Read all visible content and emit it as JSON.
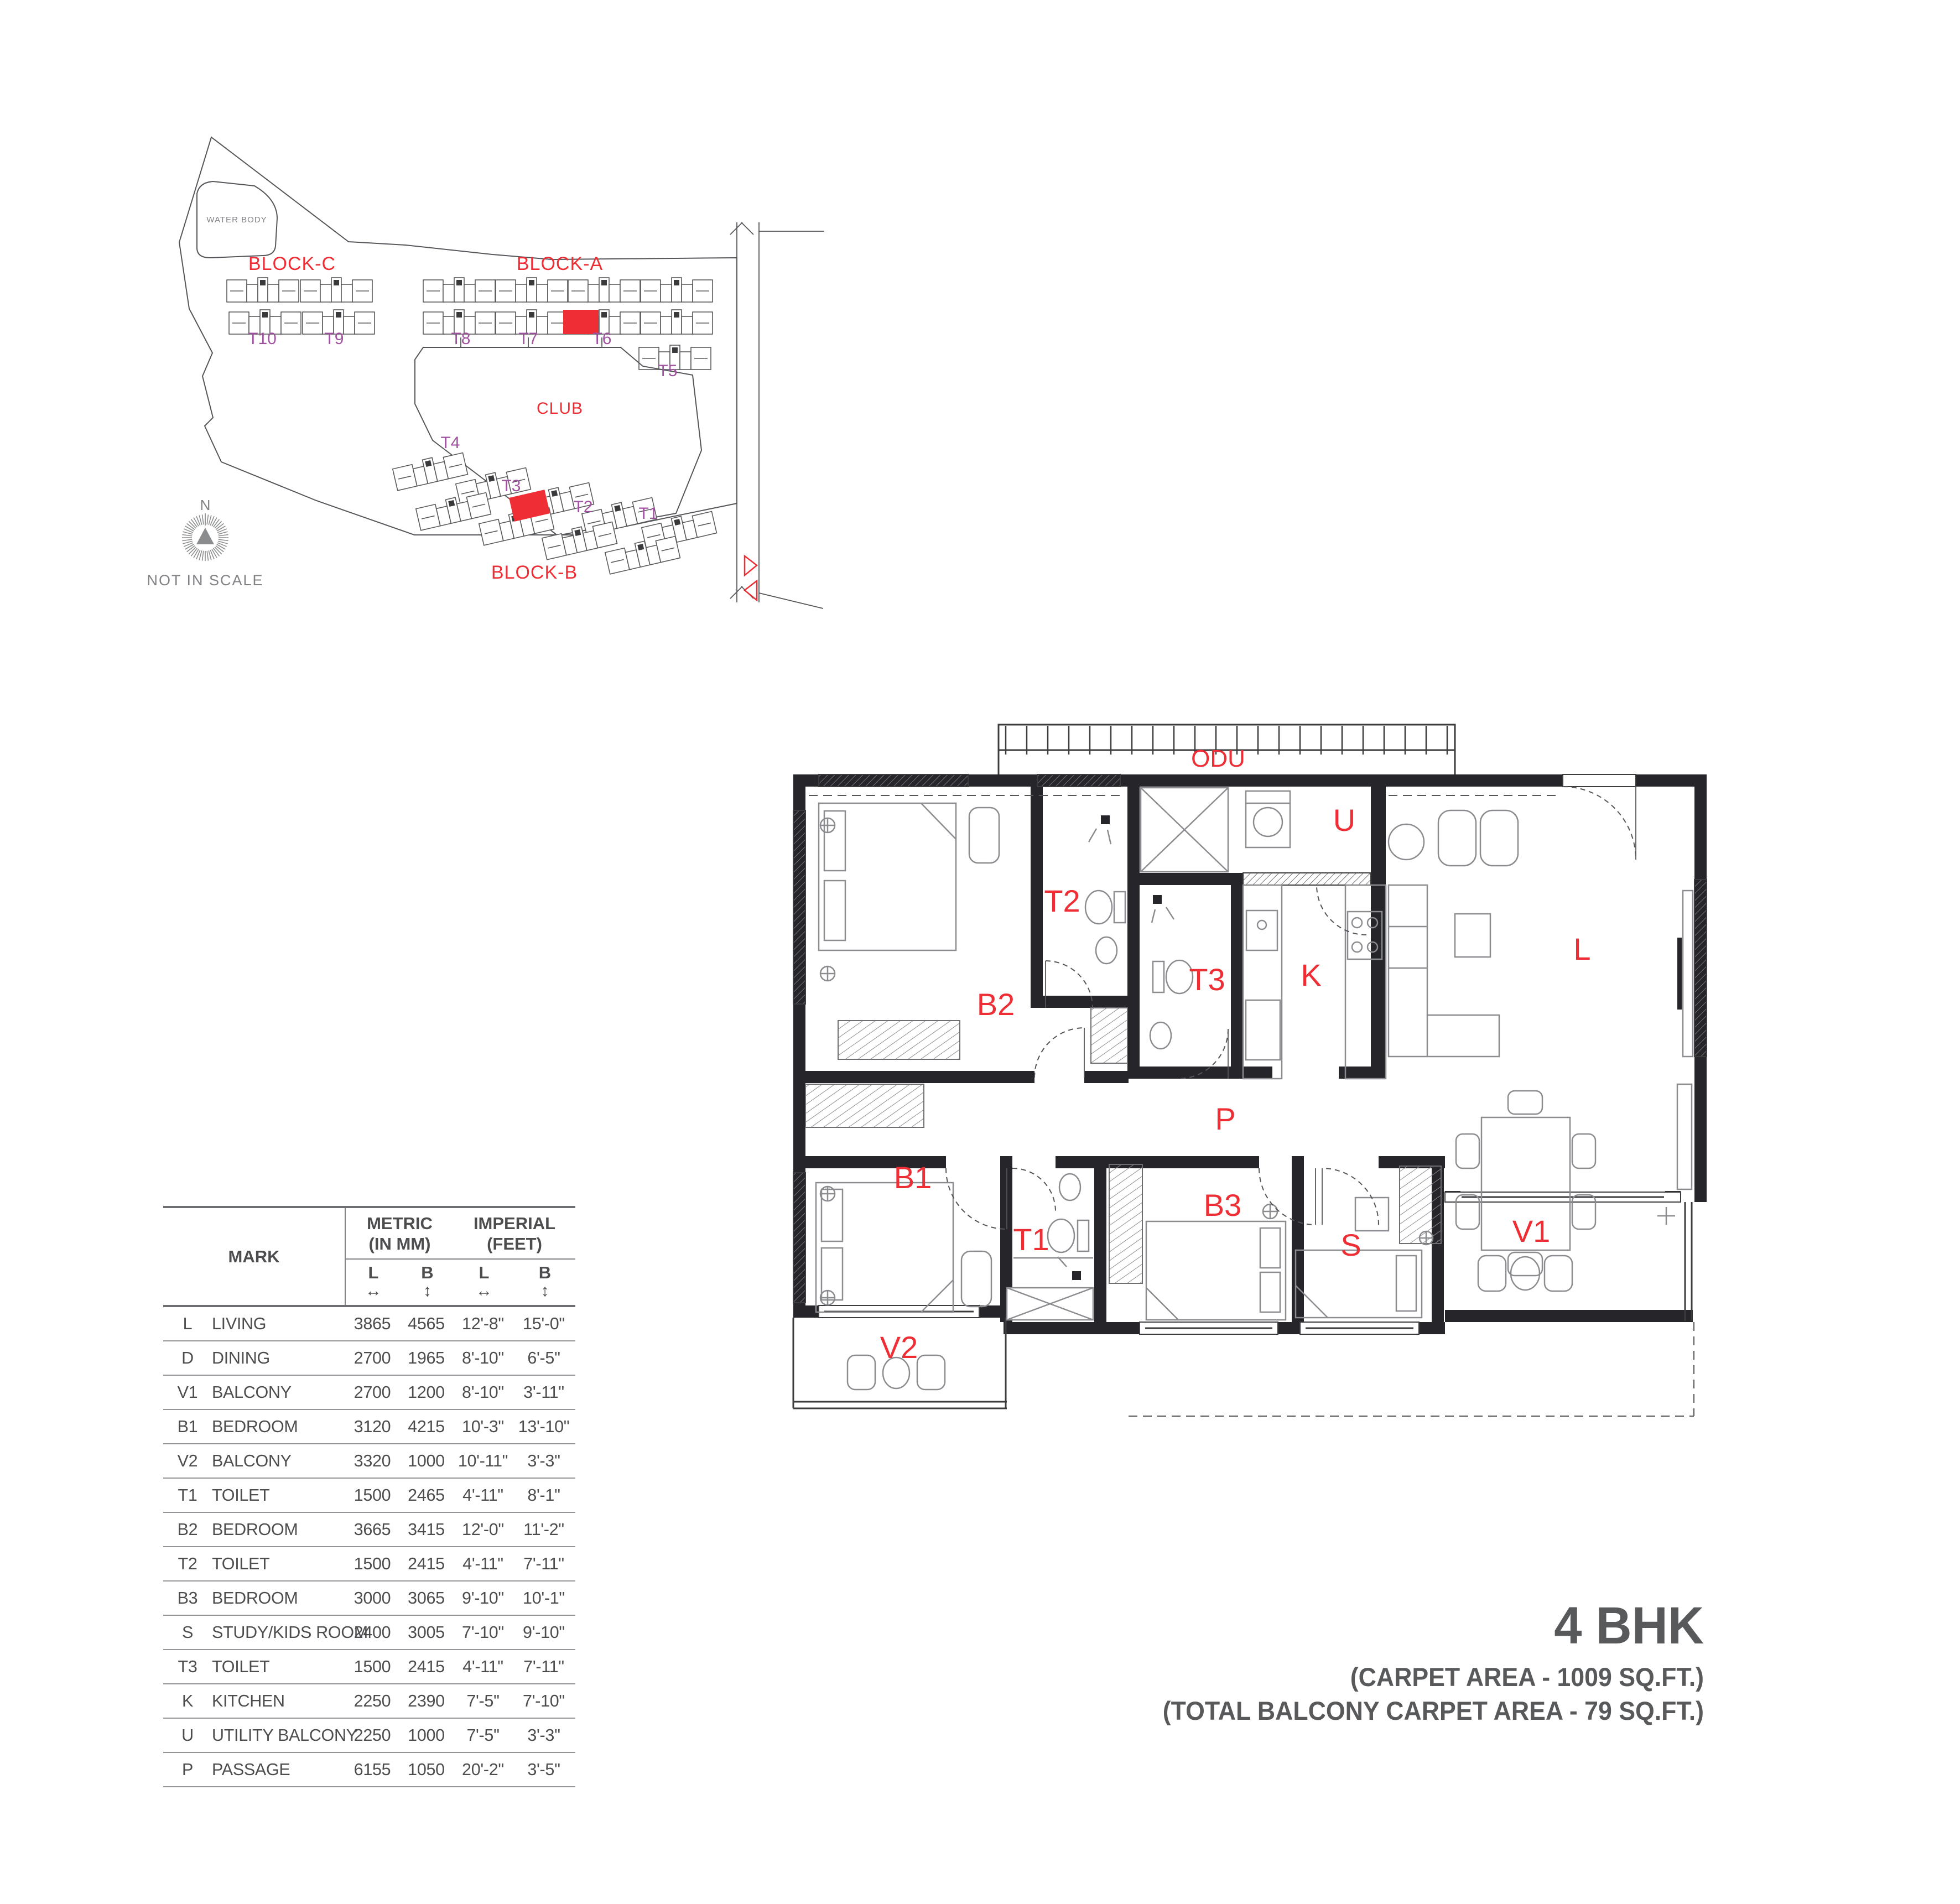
{
  "colors": {
    "accent_red": "#ee2e34",
    "tower_purple": "#a0519f",
    "title_gray": "#58595b",
    "wall_black": "#26262a"
  },
  "site_plan": {
    "water_body_label": "WATER BODY",
    "block_c": "BLOCK-C",
    "block_a": "BLOCK-A",
    "block_b": "BLOCK-B",
    "club_label": "CLUB",
    "towers": {
      "t1": "T1",
      "t2": "T2",
      "t3": "T3",
      "t4": "T4",
      "t5": "T5",
      "t6": "T6",
      "t7": "T7",
      "t8": "T8",
      "t9": "T9",
      "t10": "T10"
    },
    "north_label": "N",
    "scale_note": "NOT IN SCALE"
  },
  "floor_plan": {
    "labels": {
      "odu": "ODU",
      "u": "U",
      "t2": "T2",
      "t3": "T3",
      "k": "K",
      "l": "L",
      "b2": "B2",
      "p": "P",
      "b1": "B1",
      "t1": "T1",
      "b3": "B3",
      "s": "S",
      "v1": "V1",
      "v2": "V2"
    }
  },
  "dimension_table": {
    "header": {
      "mark": "MARK",
      "metric_line1": "METRIC",
      "metric_line2": "(IN MM)",
      "imperial_line1": "IMPERIAL",
      "imperial_line2": "(FEET)",
      "col_l": "L",
      "col_b": "B",
      "arrow_h": "↔",
      "arrow_v": "↕"
    },
    "rows": [
      {
        "mark": "L",
        "name": "LIVING",
        "ml": "3865",
        "mb": "4565",
        "il": "12'-8\"",
        "ib": "15'-0\""
      },
      {
        "mark": "D",
        "name": "DINING",
        "ml": "2700",
        "mb": "1965",
        "il": "8'-10\"",
        "ib": "6'-5\""
      },
      {
        "mark": "V1",
        "name": "BALCONY",
        "ml": "2700",
        "mb": "1200",
        "il": "8'-10\"",
        "ib": "3'-11\""
      },
      {
        "mark": "B1",
        "name": "BEDROOM",
        "ml": "3120",
        "mb": "4215",
        "il": "10'-3\"",
        "ib": "13'-10\""
      },
      {
        "mark": "V2",
        "name": "BALCONY",
        "ml": "3320",
        "mb": "1000",
        "il": "10'-11\"",
        "ib": "3'-3\""
      },
      {
        "mark": "T1",
        "name": "TOILET",
        "ml": "1500",
        "mb": "2465",
        "il": "4'-11\"",
        "ib": "8'-1\""
      },
      {
        "mark": "B2",
        "name": "BEDROOM",
        "ml": "3665",
        "mb": "3415",
        "il": "12'-0\"",
        "ib": "11'-2\""
      },
      {
        "mark": "T2",
        "name": "TOILET",
        "ml": "1500",
        "mb": "2415",
        "il": "4'-11\"",
        "ib": "7'-11\""
      },
      {
        "mark": "B3",
        "name": "BEDROOM",
        "ml": "3000",
        "mb": "3065",
        "il": "9'-10\"",
        "ib": "10'-1\""
      },
      {
        "mark": "S",
        "name": "STUDY/KIDS ROOM",
        "ml": "2400",
        "mb": "3005",
        "il": "7'-10\"",
        "ib": "9'-10\""
      },
      {
        "mark": "T3",
        "name": "TOILET",
        "ml": "1500",
        "mb": "2415",
        "il": "4'-11\"",
        "ib": "7'-11\""
      },
      {
        "mark": "K",
        "name": "KITCHEN",
        "ml": "2250",
        "mb": "2390",
        "il": "7'-5\"",
        "ib": "7'-10\""
      },
      {
        "mark": "U",
        "name": "UTILITY BALCONY",
        "ml": "2250",
        "mb": "1000",
        "il": "7'-5\"",
        "ib": "3'-3\""
      },
      {
        "mark": "P",
        "name": "PASSAGE",
        "ml": "6155",
        "mb": "1050",
        "il": "20'-2\"",
        "ib": "3'-5\""
      }
    ]
  },
  "title_block": {
    "line1": "4 BHK",
    "line2": "(CARPET AREA - 1009 SQ.FT.)",
    "line3": "(TOTAL BALCONY CARPET AREA - 79 SQ.FT.)"
  }
}
